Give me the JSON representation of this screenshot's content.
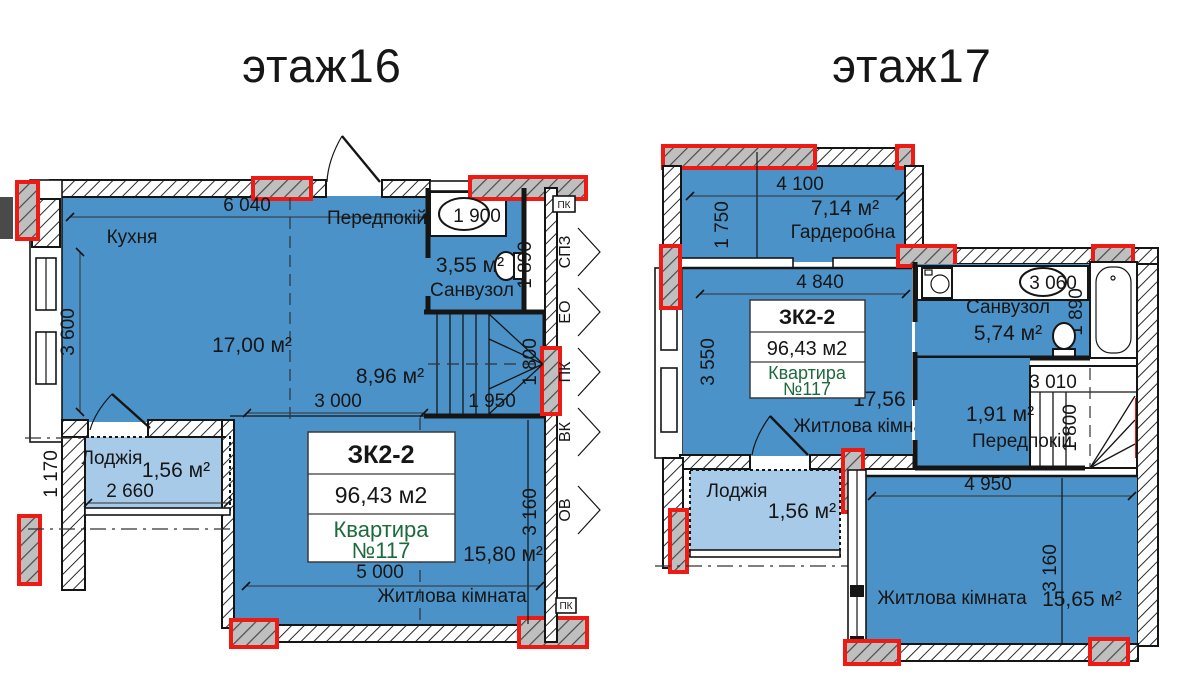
{
  "colors": {
    "room_fill": "#4a92c8",
    "loggia_fill": "#a6cae8",
    "highlight_red": "#ee1b15",
    "apartment_green": "#1d6b3c",
    "line_black": "#151515"
  },
  "floor16": {
    "title": "этаж16",
    "kitchen": {
      "name": "Кухня",
      "area": "17,00 м²",
      "dim_w": "6 040",
      "dim_h": "3 600"
    },
    "hall": {
      "name": "Передпокій",
      "area": "8,96 м²",
      "dim_w": "3 000"
    },
    "bathroom": {
      "name": "Санвузол",
      "area": "3,55 м²",
      "dim_w": "1 900",
      "dim_h": "1 890"
    },
    "stairs": {
      "dim_w": "1 950",
      "dim_h": "1 800"
    },
    "loggia": {
      "name": "Лоджія",
      "area": "1,56 м²",
      "dim_w": "2 660",
      "dim_h": "1 170"
    },
    "living": {
      "name": "Житлова кімната",
      "area": "15,80 м²",
      "dim_w": "5 000",
      "dim_h": "3 160"
    },
    "info": {
      "type": "ЗК2-2",
      "total_area": "96,43 м2",
      "apt_label": "Квартира",
      "apt_number": "№117"
    },
    "shafts": [
      "ПК",
      "СПЗ",
      "ЕО",
      "ПК",
      "ВК",
      "ОВ",
      "ПК"
    ]
  },
  "floor17": {
    "title": "этаж17",
    "wardrobe": {
      "name": "Гардеробна",
      "area": "7,14 м²",
      "dim_w": "4 100",
      "dim_h": "1 750"
    },
    "living_top": {
      "name": "Житлова кімната",
      "area": "17,56 м²",
      "dim_w": "4 840",
      "dim_h": "3 550"
    },
    "bathroom": {
      "name": "Санвузол",
      "area": "5,74 м²",
      "dim_w": "3 060",
      "dim_h": "1 890"
    },
    "hall": {
      "name": "Передпокій",
      "area": "1,91 м²",
      "dim_w": "3 010",
      "dim_h": "1 800"
    },
    "loggia": {
      "name": "Лоджія",
      "area": "1,56 м²"
    },
    "living_bottom": {
      "name": "Житлова кімната",
      "area": "15,65 м²",
      "dim_w": "4 950",
      "dim_h": "3 160"
    },
    "info": {
      "type": "ЗК2-2",
      "total_area": "96,43 м2",
      "apt_label": "Квартира",
      "apt_number": "№117"
    }
  }
}
